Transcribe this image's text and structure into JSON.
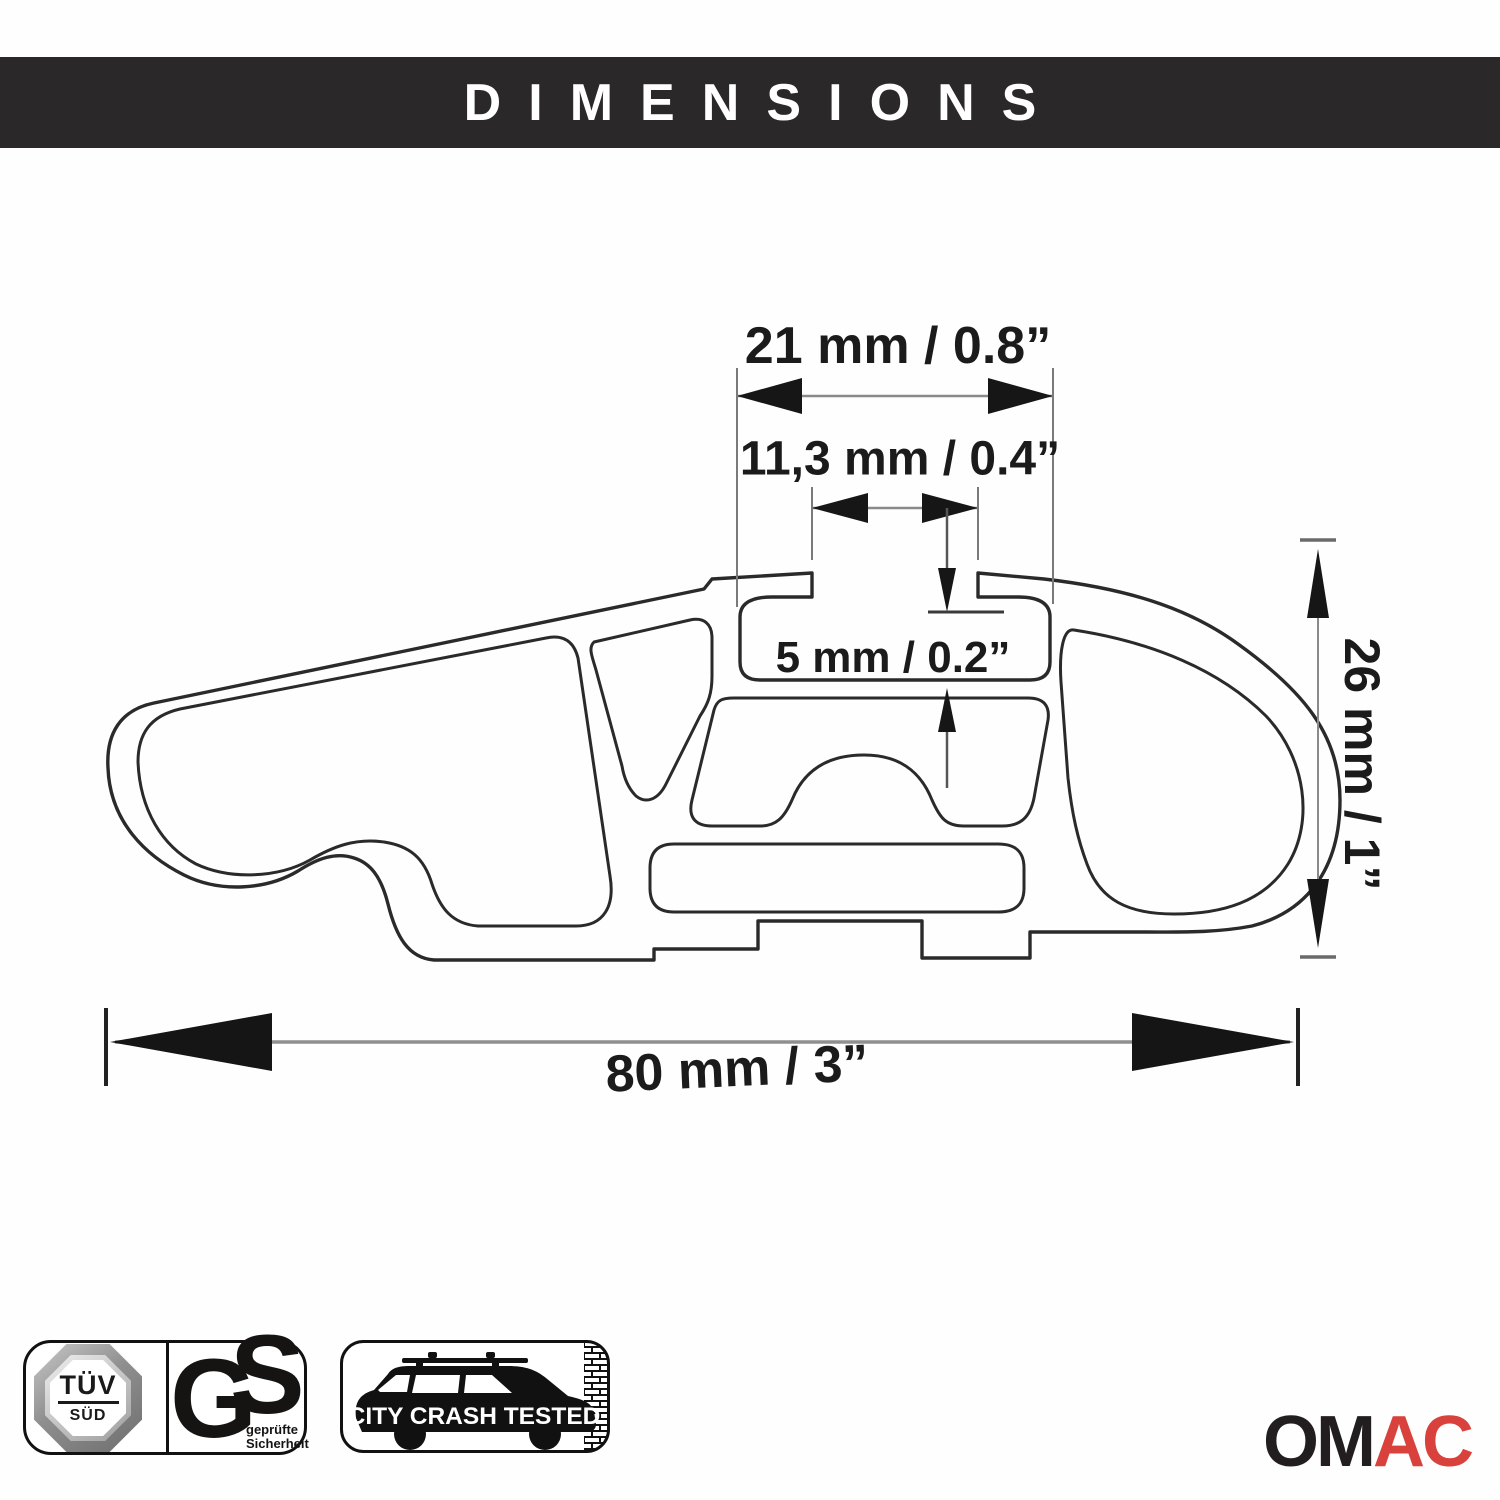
{
  "header": {
    "title": "DIMENSIONS",
    "bg_color": "#2b2829",
    "text_color": "#ffffff"
  },
  "diagram": {
    "type": "technical-cross-section",
    "subject": "roof rack crossbar aluminum profile",
    "dimensions": {
      "channel_width": "21 mm / 0.8”",
      "slot_opening": "11,3 mm / 0.4”",
      "channel_depth": "5 mm / 0.2”",
      "profile_height": "26 mm / 1”",
      "profile_width": "80 mm / 3”"
    },
    "line_color": "#2a2a2a"
  },
  "badges": {
    "tuv": {
      "line1": "TÜV",
      "line2": "SÜD"
    },
    "gs": {
      "g": "G",
      "s": "S",
      "caption_line1": "geprüfte",
      "caption_line2": "Sicherheit"
    },
    "crash": {
      "label": "CITY CRASH TESTED"
    }
  },
  "brand": {
    "om": "OM",
    "ac": "AC",
    "om_color": "#221e1f",
    "ac_color": "#d8413c"
  }
}
